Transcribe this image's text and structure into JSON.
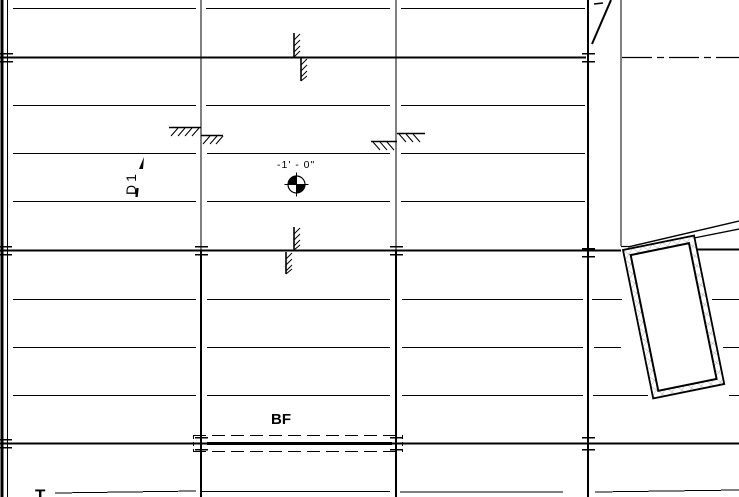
{
  "canvas": {
    "background_color": "#ffffff",
    "line_color": "#000000",
    "wall_hatch_color": "#a8a8a8"
  },
  "annotations": {
    "spot_elevation_value": "-1' - 0\"",
    "deck_span_tag": "D1",
    "beam_tag": "BF",
    "section_marker": "T"
  },
  "symbols": [
    "spot-elevation-target",
    "grid-tick-cross",
    "step-hatch-symbol",
    "edge-break-hatch-bar",
    "centerline-dash-dot",
    "shaft-wall-rectangle"
  ]
}
